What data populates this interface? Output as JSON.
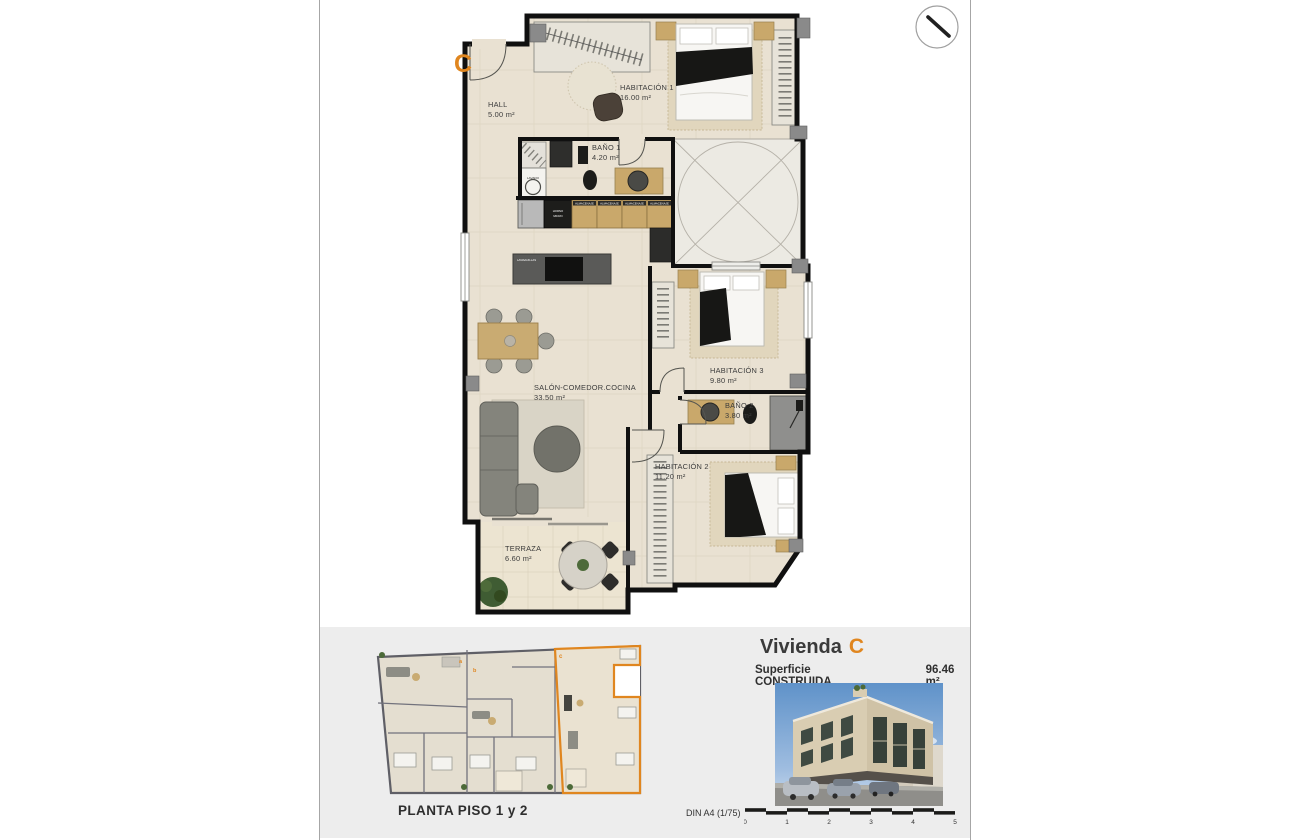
{
  "sheet": {
    "background": "#ffffff",
    "border_color": "#a6a6a6",
    "footer_bg": "#ededed"
  },
  "plan": {
    "unit_letter": "C",
    "accent_color": "#e0861f",
    "rooms": [
      {
        "name": "HALL",
        "area": "5.00 m²"
      },
      {
        "name": "HABITACIÓN 1",
        "area": "16.00 m²"
      },
      {
        "name": "BAÑO 1",
        "area": "4.20 m²"
      },
      {
        "name": "SALÓN-COMEDOR.COCINA",
        "area": "33.50 m²"
      },
      {
        "name": "HABITACIÓN 3",
        "area": "9.80 m²"
      },
      {
        "name": "BAÑO 2",
        "area": "3.80 m²"
      },
      {
        "name": "HABITACIÓN 2",
        "area": "11.20 m²"
      },
      {
        "name": "TERRAZA",
        "area": "6.60 m²"
      }
    ],
    "appliances": {
      "washer": "LAVADO",
      "oven_line1": "HORNO",
      "oven_line2": "MICRO",
      "storage": "ALMACENAJE",
      "dishwasher": "LAVAVAJILLAS"
    }
  },
  "overview": {
    "caption": "PLANTA PISO 1 y 2",
    "unit_letters": {
      "a": "a",
      "b": "b",
      "c": "c"
    }
  },
  "summary": {
    "title_prefix": "Vivienda",
    "title_letter": "C",
    "surface_label": "Superficie CONSTRUIDA",
    "surface_value": "96.46 m²"
  },
  "scalebar": {
    "label": "DIN A4 (1/75)",
    "ticks": [
      "0",
      "1",
      "2",
      "3",
      "4",
      "5"
    ]
  }
}
